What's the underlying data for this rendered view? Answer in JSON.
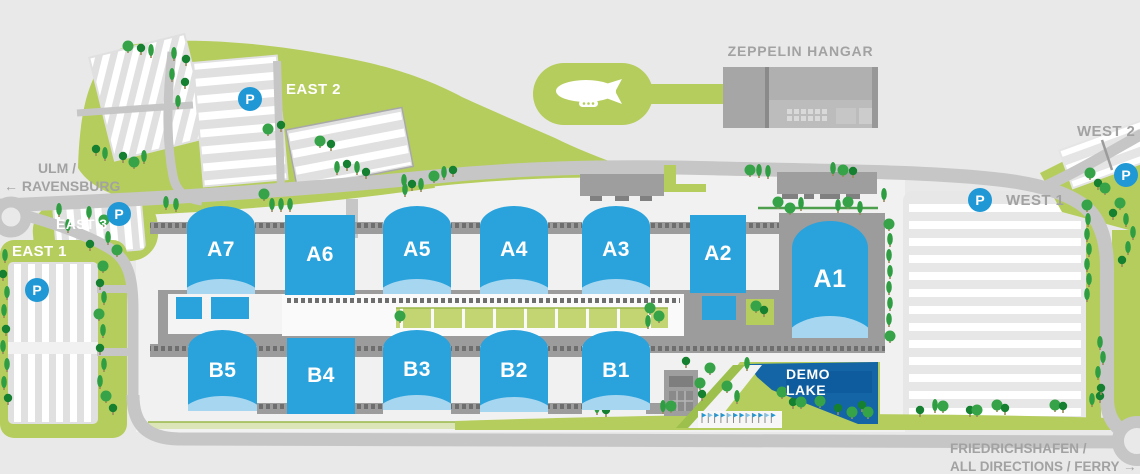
{
  "halls": [
    {
      "label": "A7"
    },
    {
      "label": "A6"
    },
    {
      "label": "A5"
    },
    {
      "label": "A4"
    },
    {
      "label": "A3"
    },
    {
      "label": "A2"
    },
    {
      "label": "A1"
    },
    {
      "label": "B5"
    },
    {
      "label": "B4"
    },
    {
      "label": "B3"
    },
    {
      "label": "B2"
    },
    {
      "label": "B1"
    }
  ],
  "parking_areas": [
    {
      "name": "east-2",
      "label": "EAST 2",
      "badge": "P"
    },
    {
      "name": "east-3",
      "label": "EAST 3",
      "badge": "P"
    },
    {
      "name": "east-1",
      "label": "EAST 1",
      "badge": "P"
    },
    {
      "name": "west-1",
      "label": "WEST 1",
      "badge": "P"
    },
    {
      "name": "west-2",
      "label": "WEST 2",
      "badge": "P"
    }
  ],
  "landmarks": {
    "zeppelin_hangar": "ZEPPELIN HANGAR",
    "demo_lake": "DEMO LAKE"
  },
  "road_signs": {
    "ulm": {
      "line1": "ULM /",
      "line2": "RAVENSBURG",
      "arrow": "←"
    },
    "friedrichshafen": {
      "line1": "FRIEDRICHSHAFEN /",
      "line2": "ALL DIRECTIONS / FERRY",
      "arrow": "→"
    }
  },
  "colors": {
    "hall_blue": "#2aa2dc",
    "hall_arc_blue": "#a7d7f0",
    "parking_badge_blue": "#1f98d5",
    "green": "#b5cd5c",
    "lake_blue": "#1465a6",
    "road_gray": "#c6c6c6",
    "label_gray": "#a2a2a2"
  }
}
